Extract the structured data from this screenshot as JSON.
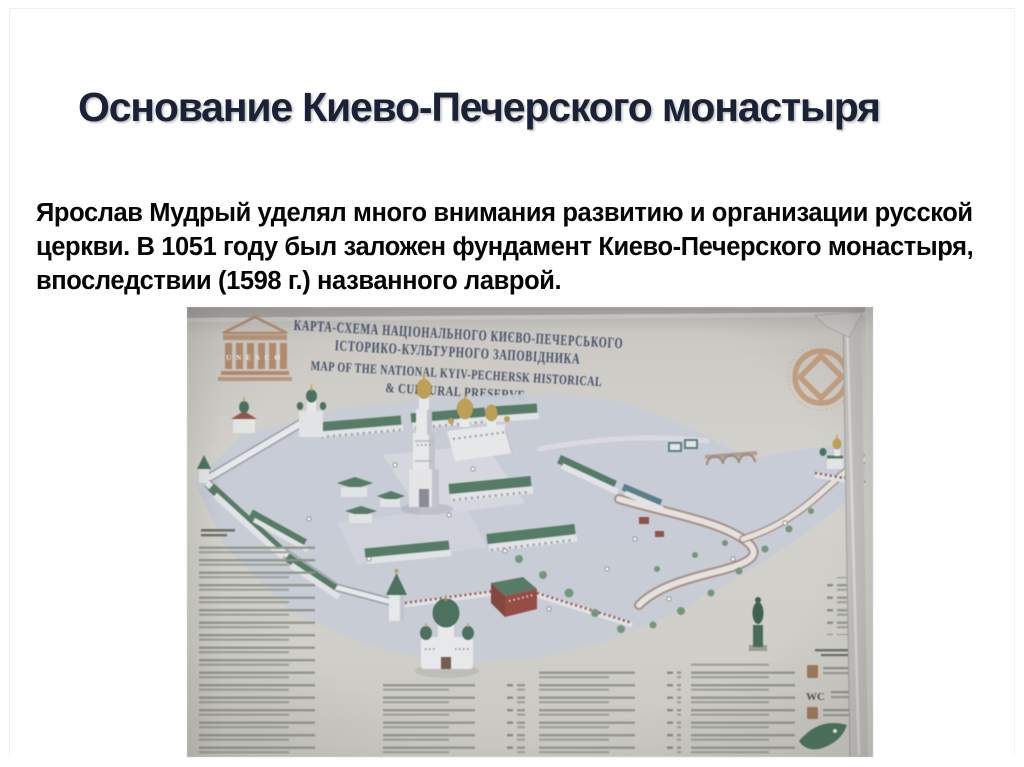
{
  "slide": {
    "title": "Основание Киево-Печерского монастыря",
    "body_lines": [
      "Ярослав Мудрый уделял много внимания развитию и организации русской",
      "церкви. В 1051 году был заложен фундамент Киево-Печерского монастыря,",
      "впоследствии (1598 г.) названного лаврой."
    ]
  },
  "map_photo": {
    "header": {
      "line1_uk": "КАРТА-СХЕМА НАЦІОНАЛЬНОГО КИЄВО-ПЕЧЕРСЬКОГО",
      "line2_uk": "ІСТОРИКО-КУЛЬТУРНОГО ЗАПОВІДНИКА",
      "line3_en": "MAP OF THE NATIONAL KYIV-PECHERSK HISTORICAL",
      "line4_en": "& CULTURAL PRESERVE",
      "unesco_letters": "UNESCO"
    },
    "labels": {
      "wc": "WC"
    },
    "colors": {
      "board": "#d8d5ce",
      "header_text": "#3d4c6e",
      "unesco_orange": "#c08a62",
      "emblem_orange": "#cf9a6c",
      "ground": "#cbd1e0",
      "roof_green": "#4c7d61",
      "dome_gold": "#c9a23f",
      "brick_red": "#a8453c"
    }
  }
}
